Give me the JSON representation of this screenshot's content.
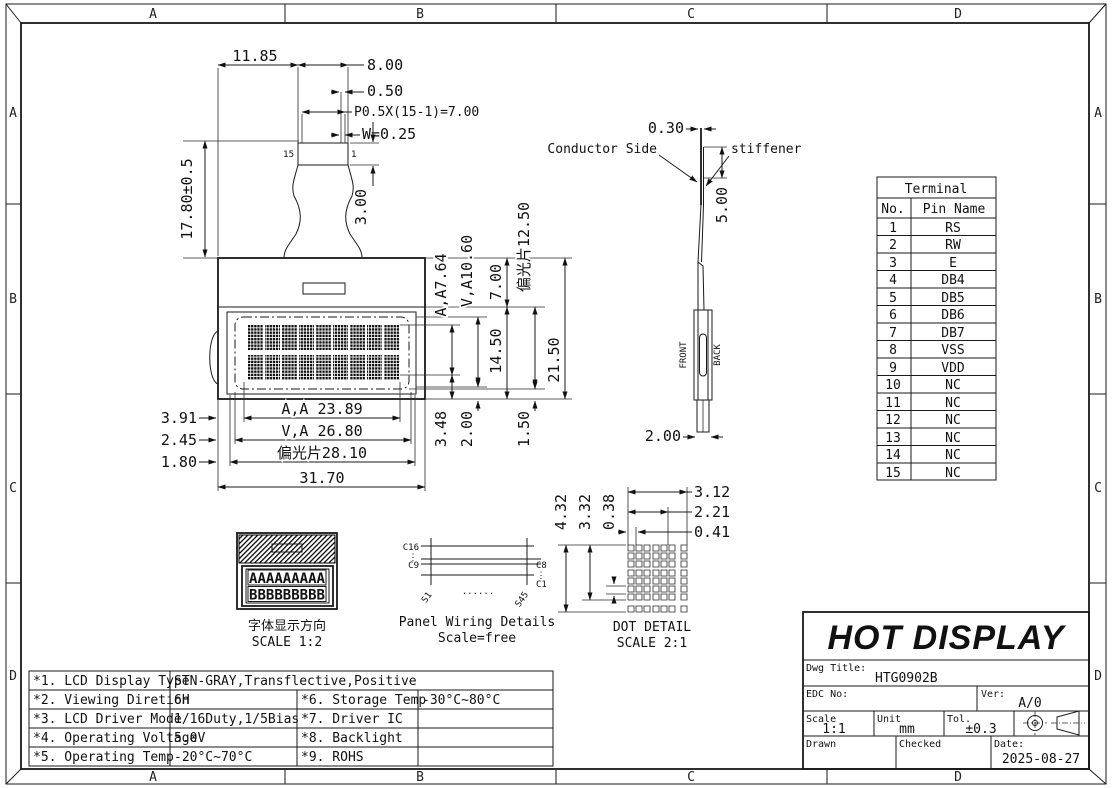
{
  "zones": {
    "cols": [
      "A",
      "B",
      "C",
      "D"
    ],
    "rows": [
      "A",
      "B",
      "C",
      "D"
    ]
  },
  "fpc": {
    "w_top": "11.85",
    "w_strip": "8.00",
    "pitch_gap": "0.50",
    "pitch": "P0.5X(15-1)=7.00",
    "finger_w": "W=0.25",
    "tail_h": "17.80±0.5",
    "strip_h": "3.00",
    "pin_left": "15",
    "pin_right": "1"
  },
  "front": {
    "heights": {
      "aa": "A,A7.64",
      "va": "V,A10.60",
      "bezel": "7.00",
      "pol": "偏光片12.50",
      "panel": "14.50",
      "total": "21.50",
      "m1": "3.48",
      "m2": "2.00",
      "m3": "1.50"
    },
    "widths": {
      "m1": "3.91",
      "m2": "2.45",
      "m3": "1.80",
      "aa": "A,A 23.89",
      "va": "V,A 26.80",
      "pol": "偏光片28.10",
      "total": "31.70"
    }
  },
  "side": {
    "thickness": "0.30",
    "conductor_label": "Conductor Side",
    "stiffener_label": "stiffener",
    "stiffener_len": "5.00",
    "front_label": "FRONT",
    "back_label": "BACK",
    "width": "2.00"
  },
  "terminal": {
    "title": "Terminal",
    "col_no": "No.",
    "col_pin": "Pin Name",
    "rows": [
      {
        "no": "1",
        "pin": "RS"
      },
      {
        "no": "2",
        "pin": "RW"
      },
      {
        "no": "3",
        "pin": "E"
      },
      {
        "no": "4",
        "pin": "DB4"
      },
      {
        "no": "5",
        "pin": "DB5"
      },
      {
        "no": "6",
        "pin": "DB6"
      },
      {
        "no": "7",
        "pin": "DB7"
      },
      {
        "no": "8",
        "pin": "VSS"
      },
      {
        "no": "9",
        "pin": "VDD"
      },
      {
        "no": "10",
        "pin": "NC"
      },
      {
        "no": "11",
        "pin": "NC"
      },
      {
        "no": "12",
        "pin": "NC"
      },
      {
        "no": "13",
        "pin": "NC"
      },
      {
        "no": "14",
        "pin": "NC"
      },
      {
        "no": "15",
        "pin": "NC"
      }
    ]
  },
  "font_view": {
    "row1": "AAAAAAAAA",
    "row2": "BBBBBBBBB",
    "caption": "字体显示方向",
    "scale": "SCALE 1:2"
  },
  "wiring": {
    "c16": "C16",
    "c9": "C9",
    "c8": "C8",
    "c1": "C1",
    "s1": "S1",
    "s45": "S45",
    "vdots": "⋮",
    "vdots2": "⋮",
    "hdots": "......",
    "caption": "Panel Wiring Details",
    "scale": "Scale=free"
  },
  "dot_detail": {
    "w1": "3.12",
    "w2": "2.21",
    "w3": "0.41",
    "h1": "4.32",
    "h2": "3.32",
    "h3": "0.38",
    "caption": "DOT DETAIL",
    "scale": "SCALE 2:1"
  },
  "title_block": {
    "brand": "HOT DISPLAY",
    "dwg_title_label": "Dwg Title:",
    "dwg_title": "HTG0902B",
    "edc_label": "EDC No:",
    "edc": "",
    "ver_label": "Ver:",
    "ver": "A/0",
    "scale_label": "Scale",
    "scale": "1:1",
    "unit_label": "Unit",
    "unit": "mm",
    "tol_label": "Tol.",
    "tol": "±0.3",
    "drawn_label": "Drawn",
    "checked_label": "Checked",
    "date_label": "Date:",
    "date": "2025-08-27"
  },
  "spec": {
    "rows": [
      {
        "k1": "*1. LCD Display Type",
        "v1": "STN-GRAY,Transflective,Positive",
        "k2": "",
        "v2": ""
      },
      {
        "k1": "*2. Viewing Diretion",
        "v1": "6H",
        "k2": "*6. Storage Temp",
        "v2": "-30°C~80°C"
      },
      {
        "k1": "*3. LCD Driver Mode",
        "v1": "1/16Duty,1/5Bias",
        "k2": "*7. Driver IC",
        "v2": ""
      },
      {
        "k1": "*4. Operating Voltage",
        "v1": "5.0V",
        "k2": "*8. Backlight",
        "v2": ""
      },
      {
        "k1": "*5. Operating Temp",
        "v1": "-20°C~70°C",
        "k2": "*9. ROHS",
        "v2": ""
      }
    ]
  }
}
